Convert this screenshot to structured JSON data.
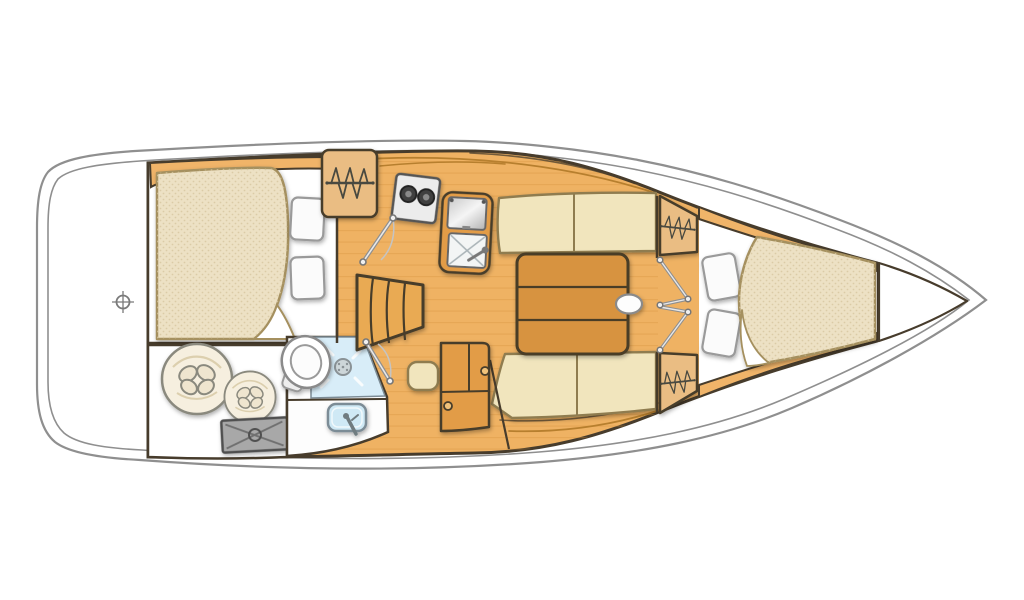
{
  "scene": {
    "type": "sailboat-interior-floor-plan",
    "view": "top-down",
    "orientation": "bow-right-stern-left"
  },
  "colors": {
    "background": "#ffffff",
    "hull_line": "#8f8f8f",
    "outline": "#473c2c",
    "floor_wood": "#efb263",
    "plank_line": "#d3913b",
    "cabinet_wood": "#e29c47",
    "trim_wood": "#f0b469",
    "table_wood": "#d79340",
    "steps_wood": "#e9aa53",
    "locker_wood": "#eabd83",
    "cushion": "#f1e5bd",
    "cushion_line": "#8f7c50",
    "mattress": "#ede1c4",
    "mattress_line": "#a5905f",
    "pillow": "#fbfbfb",
    "shower_blue": "#d8edf8",
    "sink_blue": "#cfe9f5",
    "stove_white": "#ececec",
    "metal_gray": "#d9d9d9",
    "hatch_gray": "#a8a8a8",
    "fender_cream": "#f6efdf",
    "white_room": "#ffffff"
  },
  "rooms": [
    {
      "name": "transom-deck"
    },
    {
      "name": "aft-double-cabin"
    },
    {
      "name": "aft-storage-locker"
    },
    {
      "name": "head-shower-room"
    },
    {
      "name": "hanging-locker-aft"
    },
    {
      "name": "galley"
    },
    {
      "name": "companionway-steps"
    },
    {
      "name": "saloon"
    },
    {
      "name": "hanging-locker-forward-top"
    },
    {
      "name": "hanging-locker-forward-bottom"
    },
    {
      "name": "forward-v-berth-cabin"
    },
    {
      "name": "anchor-locker"
    }
  ],
  "furniture": [
    {
      "name": "aft-berth-mattress"
    },
    {
      "name": "aft-berth-pillows"
    },
    {
      "name": "fenders"
    },
    {
      "name": "deck-hatch"
    },
    {
      "name": "toilet"
    },
    {
      "name": "shower-drain"
    },
    {
      "name": "washbasin"
    },
    {
      "name": "two-burner-stove"
    },
    {
      "name": "galley-counter"
    },
    {
      "name": "icebox"
    },
    {
      "name": "galley-sink"
    },
    {
      "name": "saloon-table"
    },
    {
      "name": "table-handle"
    },
    {
      "name": "stool"
    },
    {
      "name": "storage-cabinet"
    },
    {
      "name": "starboard-settee"
    },
    {
      "name": "port-settee"
    },
    {
      "name": "v-berth-mattress"
    },
    {
      "name": "v-berth-pillows"
    },
    {
      "name": "cabin-doors"
    }
  ],
  "icons": [
    {
      "name": "hanging-locker-icon",
      "meaning": "clothes rod with hangers",
      "count": 3
    },
    {
      "name": "datum-crosshair-icon",
      "meaning": "centreline datum mark on transom"
    },
    {
      "name": "drain-icon",
      "meaning": "shower drain"
    },
    {
      "name": "burner-icon",
      "meaning": "stove burners",
      "count": 2
    }
  ]
}
